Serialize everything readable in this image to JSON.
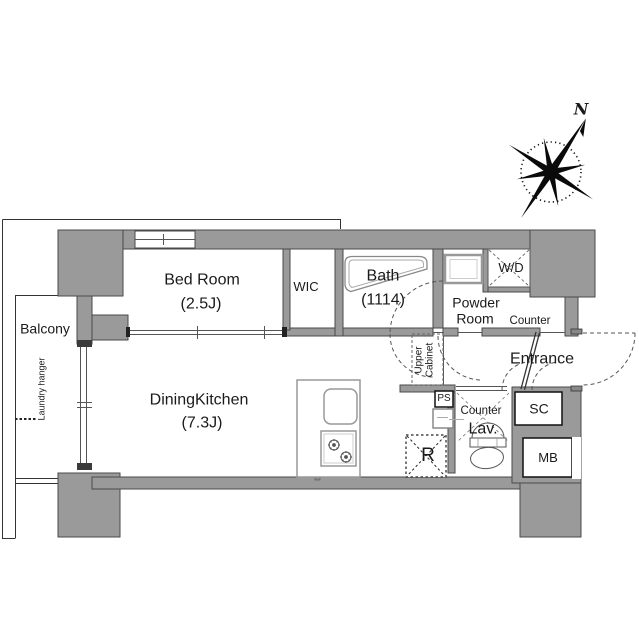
{
  "colors": {
    "wall": "#9a9a9a",
    "outline": "#4a4a4a",
    "line": "#555555",
    "light_line": "#999999",
    "text": "#1a1a1a"
  },
  "compass": {
    "north_label": "N"
  },
  "balcony": {
    "label": "Balcony",
    "laundry_hanger_label": "Laundry hanger"
  },
  "rooms": {
    "bedroom": {
      "name": "Bed Room",
      "size": "(2.5J)"
    },
    "wic": {
      "name": "WIC"
    },
    "bath": {
      "name": "Bath",
      "size": "(1114)"
    },
    "powder_room": {
      "name_line1": "Powder",
      "name_line2": "Room",
      "counter_label": "Counter"
    },
    "dining_kitchen": {
      "name": "DiningKitchen",
      "size": "(7.3J)"
    },
    "entrance": {
      "name": "Entrance"
    },
    "lavatory": {
      "name": "Lav.",
      "counter_label": "Counter"
    }
  },
  "fixtures": {
    "washer_dryer": "W/D",
    "shoe_closet": "SC",
    "meter_box": "MB",
    "pipe_space": "PS",
    "refrigerator": "R",
    "upper_cabinet_line1": "Upper",
    "upper_cabinet_line2": "Cabinet"
  }
}
